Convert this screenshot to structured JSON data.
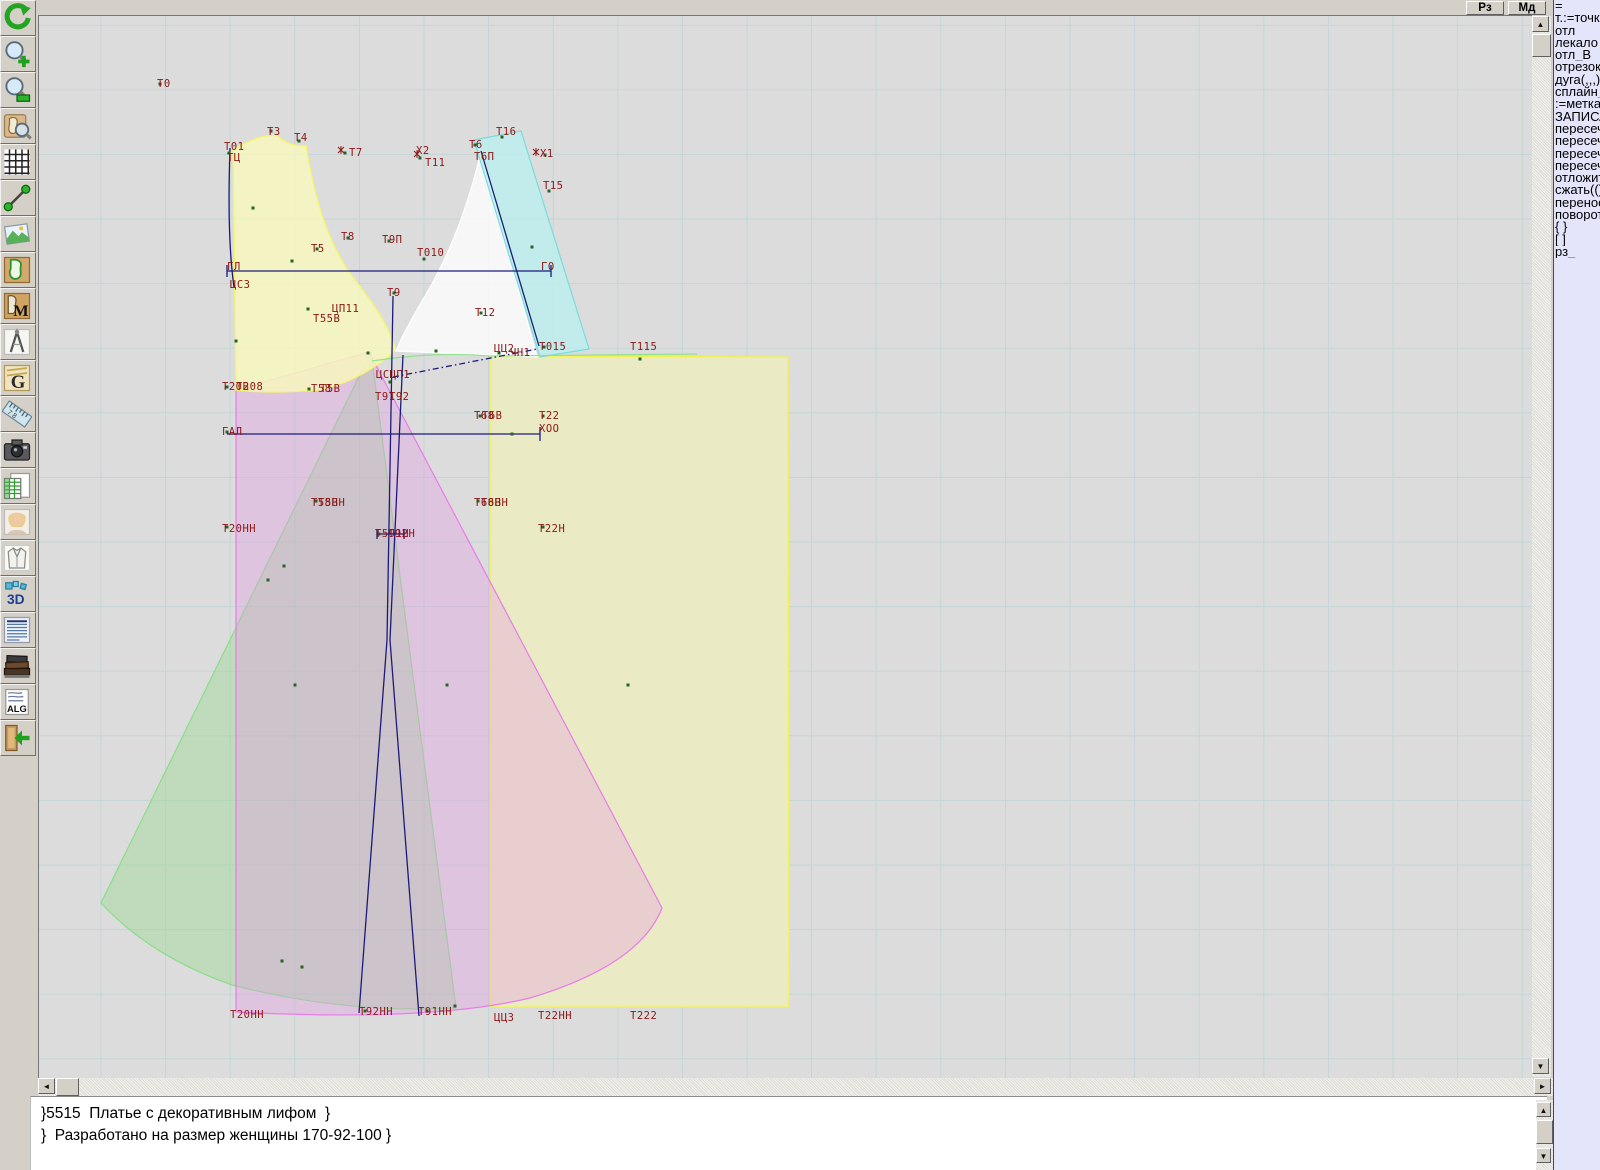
{
  "topbar": {
    "buttons": [
      {
        "label": "Рз"
      },
      {
        "label": "Мд"
      }
    ]
  },
  "toolbar": {
    "icons": [
      {
        "name": "undo-icon"
      },
      {
        "name": "zoom-in-icon"
      },
      {
        "name": "zoom-out-icon"
      },
      {
        "name": "preview-piece-icon"
      },
      {
        "name": "grid-icon"
      },
      {
        "name": "measure-line-icon"
      },
      {
        "name": "image-icon"
      },
      {
        "name": "pattern-piece-icon"
      },
      {
        "name": "pattern-m-icon"
      },
      {
        "name": "compass-icon"
      },
      {
        "name": "g-letter-icon"
      },
      {
        "name": "ruler-icon"
      },
      {
        "name": "camera-icon"
      },
      {
        "name": "table-doc-icon"
      },
      {
        "name": "portrait-icon"
      },
      {
        "name": "garment-icon"
      },
      {
        "name": "three-d-icon"
      },
      {
        "name": "text-doc-icon"
      },
      {
        "name": "books-icon"
      },
      {
        "name": "alg-icon"
      },
      {
        "name": "exit-icon"
      }
    ]
  },
  "sidebar": {
    "items": [
      "=",
      "т.:=точка",
      "отл",
      "лекало",
      "отл_В",
      "отрезок",
      "дуга(,,,)",
      "сплайн_",
      ":=метка",
      "ЗАПИСА",
      "пересеч",
      "пересеч",
      "пересеч",
      "пересеч",
      "отложит",
      "сжать(()",
      "перенос",
      "поворот",
      "{  }",
      "[  ]",
      "рз_"
    ]
  },
  "status": {
    "lines": [
      "}5515  Платье с декоративным лифом  }",
      "}  Разработано на размер женщины 170-92-100 }"
    ]
  },
  "scrollbar_glyphs": {
    "up": "▲",
    "down": "▼",
    "left": "◄",
    "right": "►"
  },
  "canvas": {
    "background": "#dcdcdc",
    "grid": {
      "x0": 101,
      "y0": 25.2,
      "step": 64.6,
      "color": "#c3d6d6"
    },
    "label_color": "#8b1616",
    "line_color": "#1b1b78",
    "point_color": "#276327",
    "shapes": [
      {
        "name": "skirt-panel-yellow",
        "d": "M490,356 L788,357 L789,1007 L490,1007 Z",
        "fill": "#eaeac5",
        "stroke": "#f2f24e",
        "sw": 1.3
      },
      {
        "name": "skirt-front-green",
        "d": "M371,352 L101,903 Q150,956 232,985 Q345,1014 456,1008 Z",
        "fill": "rgba(150,215,140,0.40)",
        "stroke": "#8ade8a",
        "sw": 1.2
      },
      {
        "name": "skirt-back-magenta",
        "d": "M369,352 L236,390 L236,1012 Q430,1022 530,998 Q640,965 662,908 Z",
        "fill": "rgba(232,150,232,0.33)",
        "stroke": "#e87ce8",
        "sw": 1.2
      },
      {
        "name": "bodice-back-yellow",
        "d": "M233,150 C250,140 266,133 277,136 Q290,147 306,146 C316,208 331,247 352,276 C371,300 389,325 396,350 Q360,382 318,390 Q270,394 236,390 Z",
        "fill": "rgba(247,247,190,0.85)",
        "stroke": "#f6f666",
        "sw": 1.3
      },
      {
        "name": "bodice-front-white",
        "d": "M481,152 C466,215 446,262 421,303 Q404,332 396,351 L537,357 Z",
        "fill": "rgba(252,252,252,0.85)",
        "stroke": "#ffffff",
        "sw": 1.3
      },
      {
        "name": "side-strip-cyan",
        "d": "M474,140 L521,131 L589,349 L540,357 Z",
        "fill": "rgba(187,240,240,0.78)",
        "stroke": "#79dcdc",
        "sw": 1.2
      },
      {
        "name": "waist-curve-green",
        "d": "M372,361 C420,354 455,353 490,356 L697,354",
        "fill": "none",
        "stroke": "#92e092",
        "sw": 1.2
      }
    ],
    "lines": [
      {
        "d": "M230,148 C228,205 229,252 234,287"
      },
      {
        "d": "M227,271 L551,271"
      },
      {
        "d": "M227,265 L227,277"
      },
      {
        "d": "M551,265 L551,277"
      },
      {
        "d": "M227,434 L540,434"
      },
      {
        "d": "M540,427 L540,441"
      },
      {
        "d": "M481,151 L539,346"
      },
      {
        "d": "M393,377 L537,349",
        "dash": "6 3 1.5 3"
      },
      {
        "d": "M393,296 L387,640 L359,1013"
      },
      {
        "d": "M403,355 L390,640 L419,1016"
      },
      {
        "d": "M377,534 L404,534 M377,529 L377,539 M404,529 L404,539"
      }
    ],
    "labels": [
      {
        "t": "Т0",
        "x": 157,
        "y": 78
      },
      {
        "t": "Т3",
        "x": 267,
        "y": 126
      },
      {
        "t": "Т4",
        "x": 294,
        "y": 132
      },
      {
        "t": "Т01",
        "x": 224,
        "y": 141
      },
      {
        "t": "ТЦ",
        "x": 227,
        "y": 152
      },
      {
        "t": "Т7",
        "x": 349,
        "y": 147
      },
      {
        "t": "Х2",
        "x": 416,
        "y": 145
      },
      {
        "t": "Т11",
        "x": 425,
        "y": 157
      },
      {
        "t": "Т6",
        "x": 469,
        "y": 139
      },
      {
        "t": "Т16",
        "x": 496,
        "y": 126
      },
      {
        "t": "Т6П",
        "x": 474,
        "y": 151
      },
      {
        "t": "Х1",
        "x": 540,
        "y": 148
      },
      {
        "t": "Т15",
        "x": 543,
        "y": 180
      },
      {
        "t": "Т8",
        "x": 341,
        "y": 231
      },
      {
        "t": "Т5",
        "x": 311,
        "y": 243
      },
      {
        "t": "Т9П",
        "x": 382,
        "y": 234
      },
      {
        "t": "Т010",
        "x": 417,
        "y": 247
      },
      {
        "t": "ГЛ",
        "x": 227,
        "y": 261
      },
      {
        "t": "ГО",
        "x": 541,
        "y": 261
      },
      {
        "t": "ЦС3",
        "x": 230,
        "y": 279
      },
      {
        "t": "Т9",
        "x": 387,
        "y": 287
      },
      {
        "t": "ЦП11",
        "x": 332,
        "y": 303
      },
      {
        "t": "Т55В",
        "x": 313,
        "y": 313
      },
      {
        "t": "Т12",
        "x": 475,
        "y": 307
      },
      {
        "t": "ЦЦ2",
        "x": 494,
        "y": 343
      },
      {
        "t": "ЧН1",
        "x": 510,
        "y": 347
      },
      {
        "t": "Т015",
        "x": 539,
        "y": 341
      },
      {
        "t": "Т115",
        "x": 630,
        "y": 341
      },
      {
        "t": "ЦСЦП1",
        "x": 376,
        "y": 369
      },
      {
        "t": "Т20В",
        "x": 222,
        "y": 381
      },
      {
        "t": "Т208",
        "x": 236,
        "y": 381
      },
      {
        "t": "Т58",
        "x": 311,
        "y": 383
      },
      {
        "t": "Т5В",
        "x": 320,
        "y": 383
      },
      {
        "t": "Т91",
        "x": 375,
        "y": 391
      },
      {
        "t": "Т92",
        "x": 389,
        "y": 391
      },
      {
        "t": "Т68",
        "x": 474,
        "y": 410
      },
      {
        "t": "Т6В",
        "x": 482,
        "y": 410
      },
      {
        "t": "Т22",
        "x": 539,
        "y": 410
      },
      {
        "t": "ХОО",
        "x": 539,
        "y": 423
      },
      {
        "t": "ГАЛ",
        "x": 222,
        "y": 426
      },
      {
        "t": "Т58Н",
        "x": 311,
        "y": 497
      },
      {
        "t": "Т5ВН",
        "x": 318,
        "y": 497
      },
      {
        "t": "Т68Н",
        "x": 474,
        "y": 497
      },
      {
        "t": "Т6ВН",
        "x": 481,
        "y": 497
      },
      {
        "t": "Т20НН",
        "x": 222,
        "y": 523
      },
      {
        "t": "Т591Н",
        "x": 375,
        "y": 528
      },
      {
        "t": "Т92Н",
        "x": 388,
        "y": 528
      },
      {
        "t": "Т22Н",
        "x": 538,
        "y": 523
      },
      {
        "t": "Т20НН",
        "x": 230,
        "y": 1009
      },
      {
        "t": "Т92НН",
        "x": 359,
        "y": 1006
      },
      {
        "t": "Т91НН",
        "x": 418,
        "y": 1006
      },
      {
        "t": "ЦЦ3",
        "x": 494,
        "y": 1012
      },
      {
        "t": "Т22НН",
        "x": 538,
        "y": 1010
      },
      {
        "t": "Т222",
        "x": 630,
        "y": 1010
      }
    ],
    "points": [
      [
        160,
        84
      ],
      [
        229,
        153
      ],
      [
        271,
        131
      ],
      [
        299,
        141
      ],
      [
        345,
        153
      ],
      [
        420,
        158
      ],
      [
        475,
        145
      ],
      [
        502,
        137
      ],
      [
        545,
        155
      ],
      [
        549,
        191
      ],
      [
        253,
        208
      ],
      [
        292,
        261
      ],
      [
        317,
        249
      ],
      [
        348,
        238
      ],
      [
        389,
        241
      ],
      [
        424,
        259
      ],
      [
        532,
        247
      ],
      [
        394,
        293
      ],
      [
        308,
        309
      ],
      [
        481,
        313
      ],
      [
        236,
        341
      ],
      [
        368,
        353
      ],
      [
        390,
        382
      ],
      [
        436,
        351
      ],
      [
        499,
        353
      ],
      [
        544,
        347
      ],
      [
        640,
        359
      ],
      [
        227,
        387
      ],
      [
        309,
        389
      ],
      [
        480,
        416
      ],
      [
        543,
        416
      ],
      [
        227,
        432
      ],
      [
        512,
        434
      ],
      [
        316,
        501
      ],
      [
        478,
        501
      ],
      [
        227,
        527
      ],
      [
        379,
        534
      ],
      [
        543,
        527
      ],
      [
        284,
        566
      ],
      [
        268,
        580
      ],
      [
        295,
        685
      ],
      [
        447,
        685
      ],
      [
        628,
        685
      ],
      [
        282,
        961
      ],
      [
        302,
        967
      ],
      [
        365,
        1011
      ],
      [
        427,
        1011
      ],
      [
        455,
        1006
      ]
    ],
    "xmarkers": [
      [
        341,
        150
      ],
      [
        417,
        154
      ],
      [
        536,
        152
      ]
    ]
  }
}
